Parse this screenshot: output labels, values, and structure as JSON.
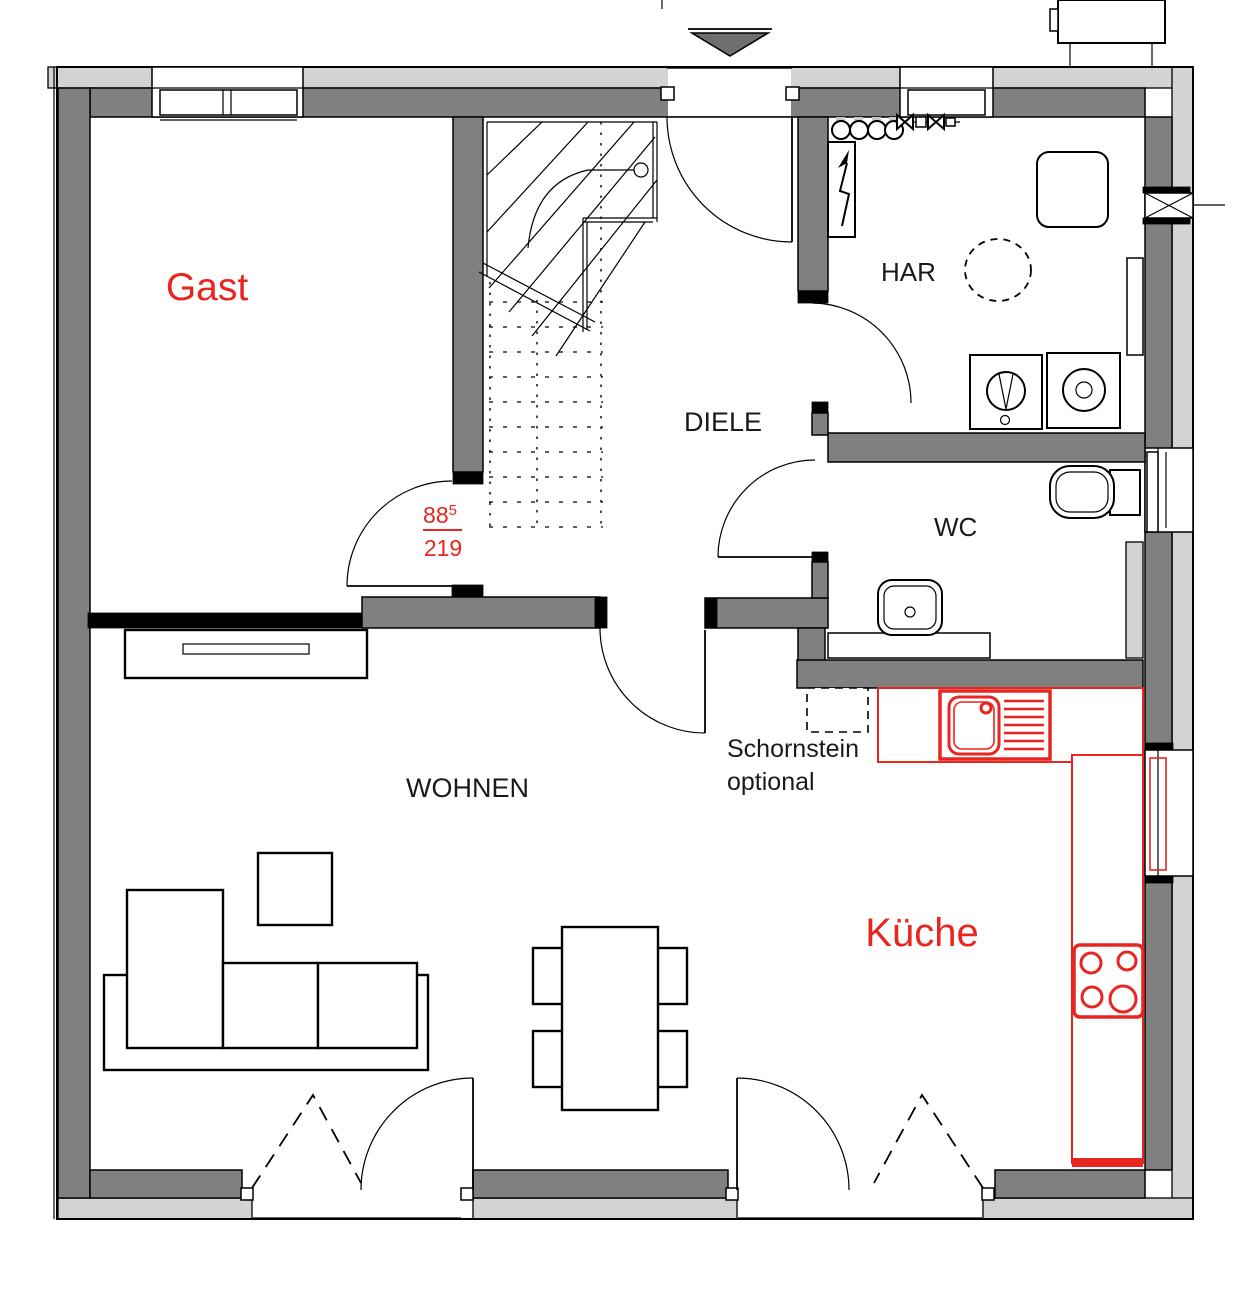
{
  "colors": {
    "accent_red": "#e8251f",
    "wall": "#808080",
    "insulation": "#d3d3d3",
    "marker_gray": "#6f6f6f"
  },
  "rooms": {
    "gast": "Gast",
    "diele": "DIELE",
    "har": "HAR",
    "wc": "WC",
    "wohnen": "WOHNEN",
    "kueche": "Küche"
  },
  "labels": {
    "chimney_line1": "Schornstein",
    "chimney_line2": "optional"
  },
  "door_dimension": {
    "numerator": "88",
    "superscript": "5",
    "denominator": "219"
  }
}
